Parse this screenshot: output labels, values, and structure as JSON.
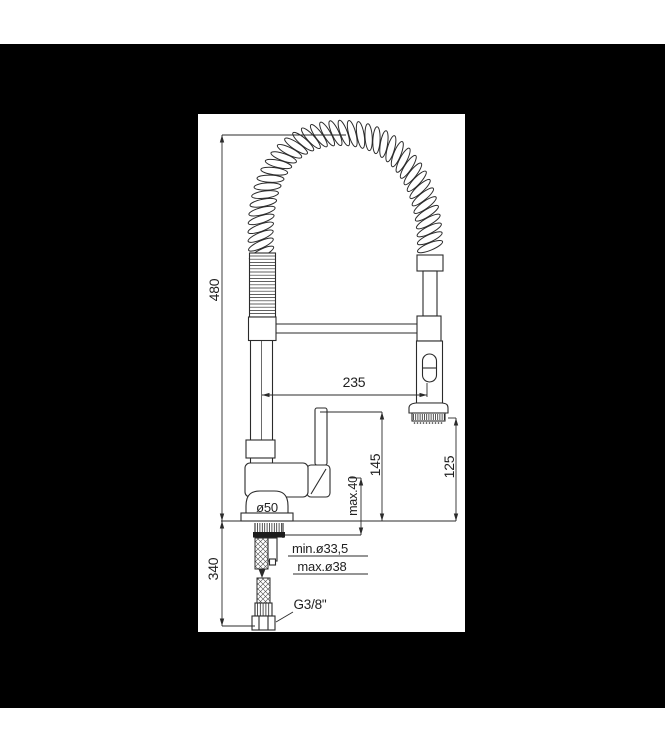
{
  "frame": {
    "background_color": "#000000",
    "panel_color": "#ffffff",
    "line_color": "#2b2b2b"
  },
  "drawing": {
    "subject": "spring pull-down kitchen faucet dimensional drawing",
    "labels": {
      "overall_height": "480",
      "below_deck_length": "340",
      "spout_reach": "235",
      "handle_height": "145",
      "spray_outlet_height": "125",
      "max_deck_thickness": "max.40",
      "base_diameter": "ø50",
      "min_hole_diameter": "min.ø33,5",
      "max_hole_diameter": "max.ø38",
      "supply_connection": "G3/8\""
    }
  }
}
